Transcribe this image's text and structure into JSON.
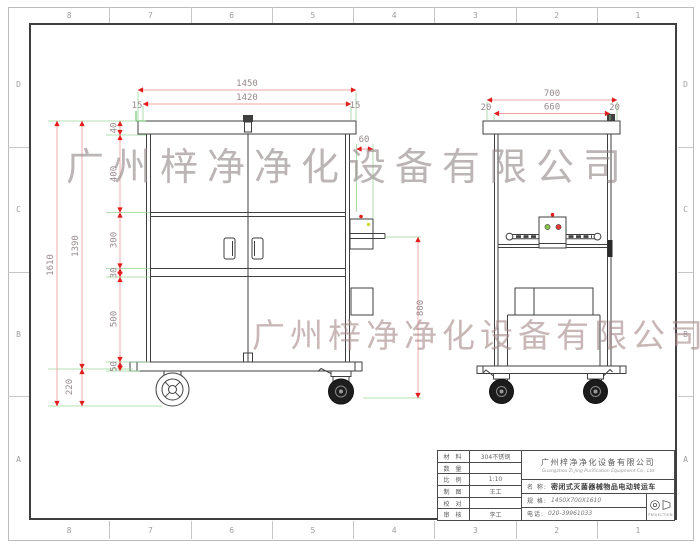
{
  "grid": {
    "top": [
      "8",
      "7",
      "6",
      "5",
      "4",
      "3",
      "2",
      "1"
    ],
    "bottom": [
      "8",
      "7",
      "6",
      "5",
      "4",
      "3",
      "2",
      "1"
    ],
    "left": [
      "D",
      "C",
      "B",
      "A"
    ],
    "right": [
      "D",
      "C",
      "B",
      "A"
    ]
  },
  "watermarks": {
    "top": "广州梓净净化设备有限公司",
    "bottom": "广州梓净净化设备有限公司"
  },
  "dims": {
    "w1450": "1450",
    "w1420": "1420",
    "off15l": "15",
    "off15r": "15",
    "h1610": "1610",
    "h1390": "1390",
    "h220": "220",
    "s40": "40",
    "s400": "400",
    "s300": "300",
    "s30": "30",
    "s500": "500",
    "s50": "50",
    "d60": "60",
    "d800": "800",
    "sv700": "700",
    "sv660": "660",
    "sv20l": "20",
    "sv20r": "20"
  },
  "title_block": {
    "rows": [
      {
        "label": "材 料",
        "value": "304不锈钢"
      },
      {
        "label": "数 量",
        "value": ""
      },
      {
        "label": "比 例",
        "value": "1:10"
      },
      {
        "label": "制 图",
        "value": "王工"
      },
      {
        "label": "校 对",
        "value": ""
      },
      {
        "label": "审 核",
        "value": "李工"
      }
    ],
    "company_cn": "广州梓净净化设备有限公司",
    "company_en": "Guangzhou Zi Jing Purification Equipment Co., Ltd",
    "name_label": "名 称:",
    "name_value": "密闭式灭菌器械物品电动转运车",
    "spec_label": "规 格:",
    "spec_value": "1450X700X1610",
    "phone_label": "电话:",
    "phone_value": "020-39961033",
    "projection_label": "PROJECTION"
  },
  "colors": {
    "dimension_arrow_red": "#e11d1d",
    "dimension_line_pink": "#f0a3a3",
    "extension_green": "#99d599",
    "drawing_line": "#3f3f3f",
    "watermark_gray": "#918787"
  }
}
